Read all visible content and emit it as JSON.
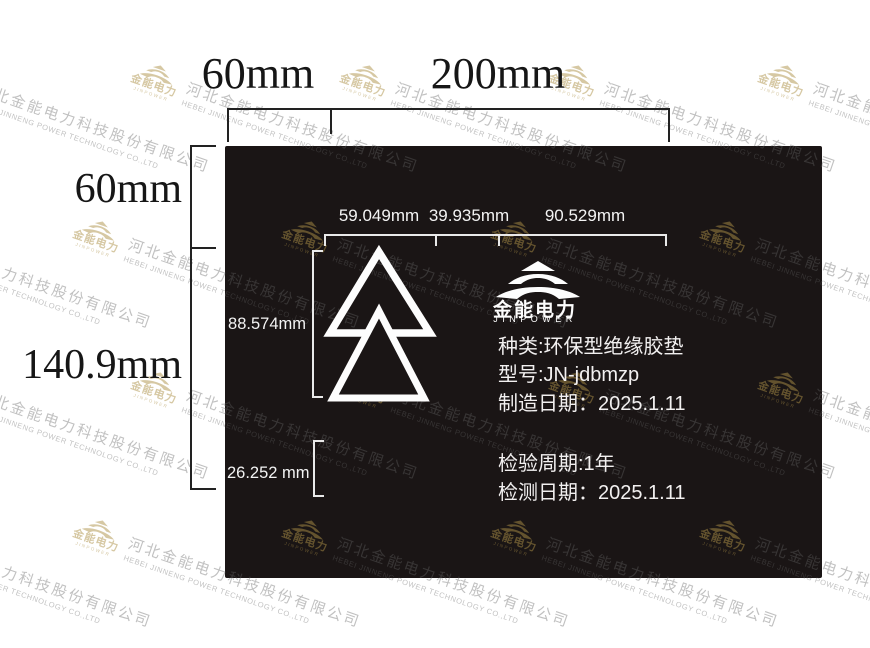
{
  "panel": {
    "bg_color": "#1a1515"
  },
  "outer_dimensions": {
    "top_segment_1": "60mm",
    "top_segment_2": "200mm",
    "left_segment_1": "60mm",
    "left_segment_2": "140.9mm"
  },
  "inner_dimensions": {
    "top_segment_1": "59.049mm",
    "top_segment_2": "39.935mm",
    "top_segment_3": "90.529mm",
    "logo_height": "88.574mm",
    "bottom_margin": "26.252 mm"
  },
  "brand": {
    "name_cn": "金能电力",
    "name_en": "JINPOWER"
  },
  "specs": {
    "type": "种类:环保型绝缘胶垫",
    "model": "型号:JN-jdbmzp",
    "mfg_date": "制造日期：2025.1.11",
    "inspection_cycle": "检验周期:1年",
    "test_date": "检测日期：2025.1.11"
  },
  "watermark": {
    "brand_cn": "金能电力",
    "brand_en": "JINPOWER",
    "company_cn": "河北金能电力科技股份有限公司",
    "company_en": "HEBEI JINNENG POWER TECHNOLOGY CO.,LTD",
    "gold_color": "rgba(173,146,72,0.5)",
    "gray_color": "rgba(100,100,100,0.4)"
  }
}
